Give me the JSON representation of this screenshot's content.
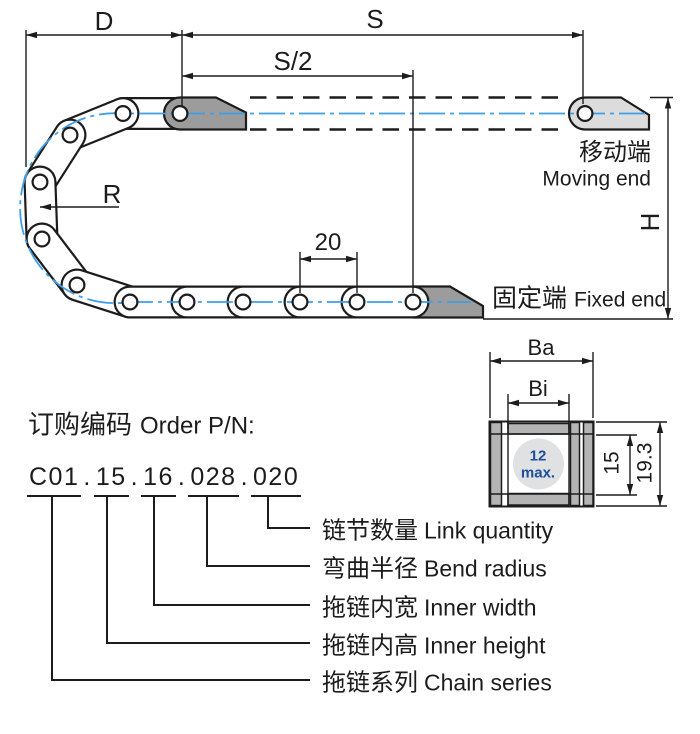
{
  "diagram": {
    "dim_d": "D",
    "dim_s": "S",
    "dim_s_half": "S/2",
    "dim_r": "R",
    "dim_pitch": "20",
    "dim_h": "H",
    "moving_end": {
      "zh": "移动端",
      "en": "Moving end"
    },
    "fixed_end": {
      "zh": "固定端",
      "en": "Fixed end"
    }
  },
  "section": {
    "dim_outer_width": "Ba",
    "dim_inner_width": "Bi",
    "cable_note_value": "12",
    "cable_note_suffix": "max.",
    "dim_inner_height": "15",
    "dim_outer_height": "19.3"
  },
  "order": {
    "title_zh": "订购编码",
    "title_en": "Order P/N:",
    "separator": ".",
    "segments": [
      {
        "code": "C01",
        "label_zh": "拖链系列",
        "label_en": "Chain series"
      },
      {
        "code": "15",
        "label_zh": "拖链内高",
        "label_en": "Inner height"
      },
      {
        "code": "16",
        "label_zh": "拖链内宽",
        "label_en": "Inner width"
      },
      {
        "code": "028",
        "label_zh": "弯曲半径",
        "label_en": "Bend radius"
      },
      {
        "code": "020",
        "label_zh": "链节数量",
        "label_en": "Link quantity"
      }
    ]
  },
  "colors": {
    "line": "#1c1c1c",
    "bracket_dark": "#9c9c9c",
    "bracket_light": "#dcdcdc",
    "section_wall": "#b4b4b4",
    "cable_circle": "#dfe1e3",
    "centerline_blue": "#3f9ee8",
    "note_blue": "#1d4f9b"
  }
}
